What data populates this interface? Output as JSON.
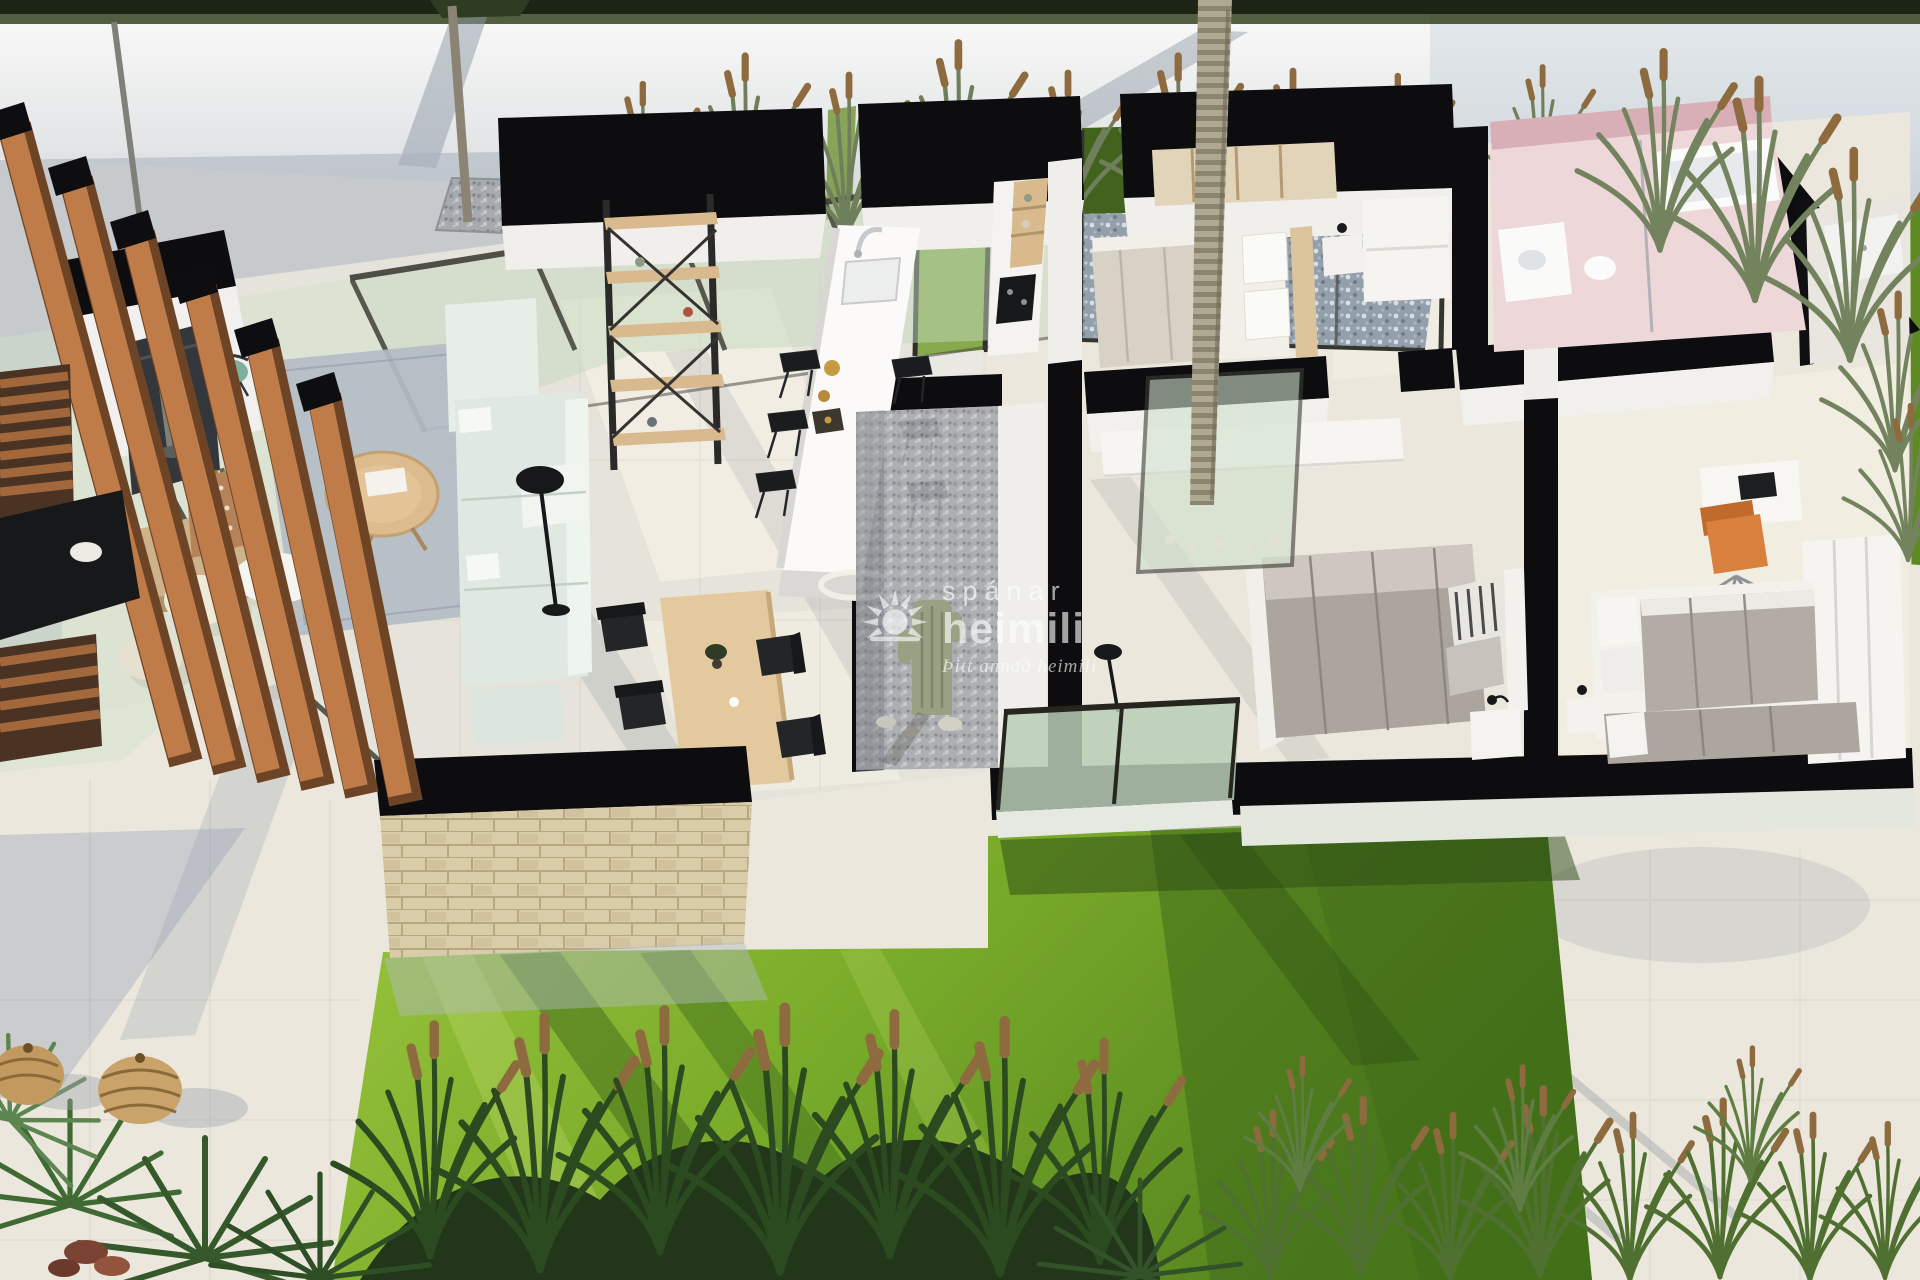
{
  "scene": {
    "title": "3D floor plan render",
    "description": "Aerial cutaway 3D rendering of a modern single-storey villa: open-plan living room with mint sofa and TV wall, kitchen island with black bar stools, wooden dining set, interior palm courtyard, three bedrooms with grey duvets, pink bathroom, stone-clad wall, wooden pergola, cream terraces, bright lawn and ornamental grasses"
  },
  "watermark": {
    "brand_line1": "spánar",
    "brand_line2": "heimili",
    "tagline": "Þitt annað heimili",
    "logo": "sun-rays-icon"
  },
  "palette": {
    "terrace": "#ebe7dc",
    "perimeter_wall_top": "#f9f9f7",
    "perimeter_wall_shadow": "#c9ced4",
    "cut_walls": "#0d0d0f",
    "lawn_sun": "#8fbc2f",
    "lawn_shade": "#3f6b1a",
    "glass_tint": "#c8ddc4",
    "pergola_wood": "#c07c48",
    "stone_wall": "#d9cda9",
    "sofa": "#dfe9e2",
    "rug": "#b3bcc6",
    "bed_duvet": "#aba59d",
    "bathroom_pink": "#eed7d9",
    "desk_chair_orange": "#d8813e"
  }
}
